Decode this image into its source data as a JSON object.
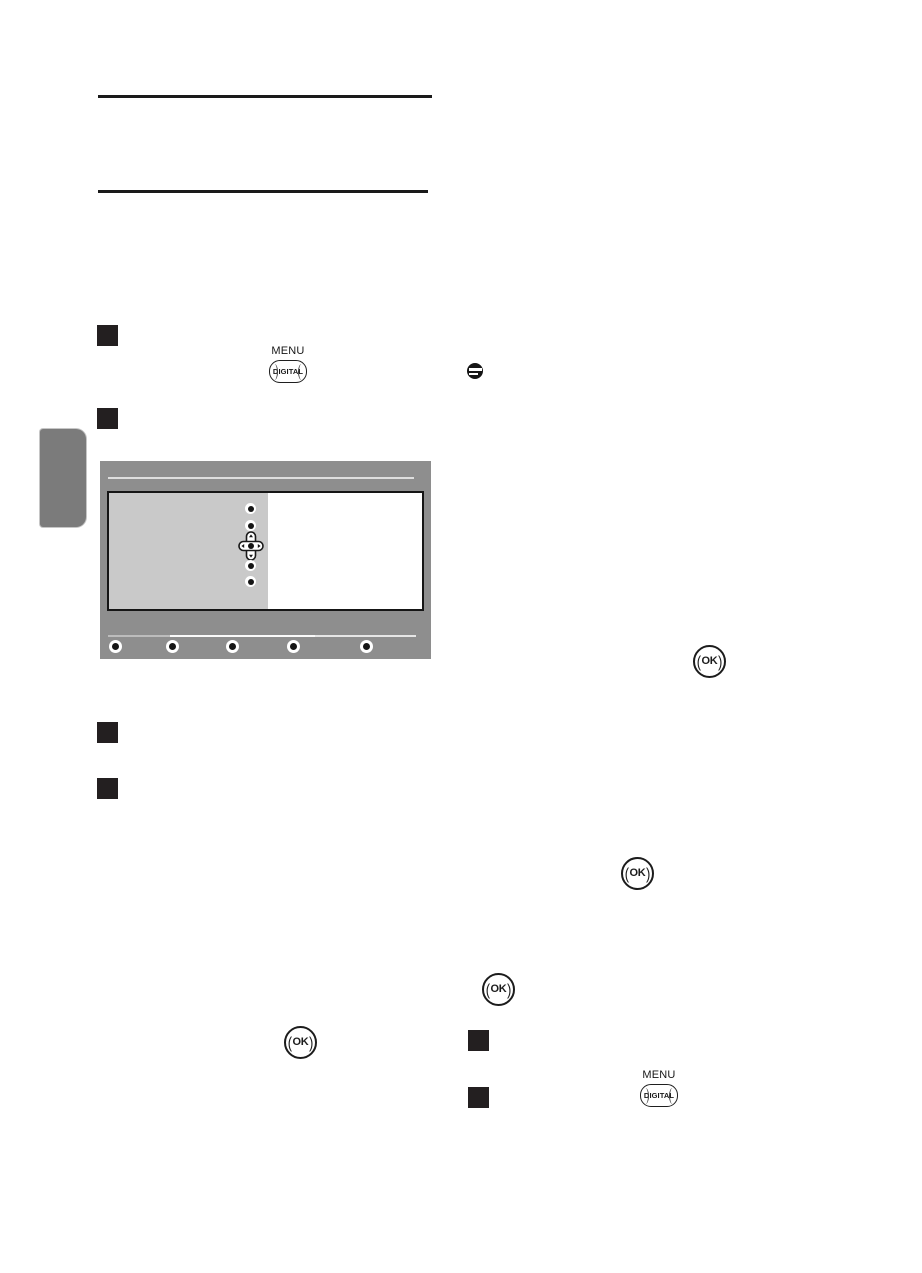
{
  "document": {
    "kind": "tv-manual-page",
    "visible_text_note": "body copy not rendered; only graphic elements visible"
  },
  "header": {
    "rule_count": 2
  },
  "steps": {
    "marker_count": 6
  },
  "remote_keys": {
    "menu_digital": {
      "top_label": "MENU",
      "face_label": "DIGITAL"
    },
    "ok": {
      "paren_open": "(",
      "label": "OK",
      "paren_close": ")"
    }
  },
  "icons": {
    "note": "note-icon (black circle with two white bars)",
    "dpad": "navigation-cross-icon"
  },
  "tv_menu_mockup": {
    "nav_dot_count": 5,
    "color_key_count": 5,
    "colors": {
      "frame": "#8e8e8e",
      "left_pane": "#c9c9c9",
      "right_pane": "#ffffff",
      "border": "#151515",
      "side_tab": "#7b7b7b",
      "step_marker": "#231f20",
      "rule": "#1a1a1a"
    }
  }
}
